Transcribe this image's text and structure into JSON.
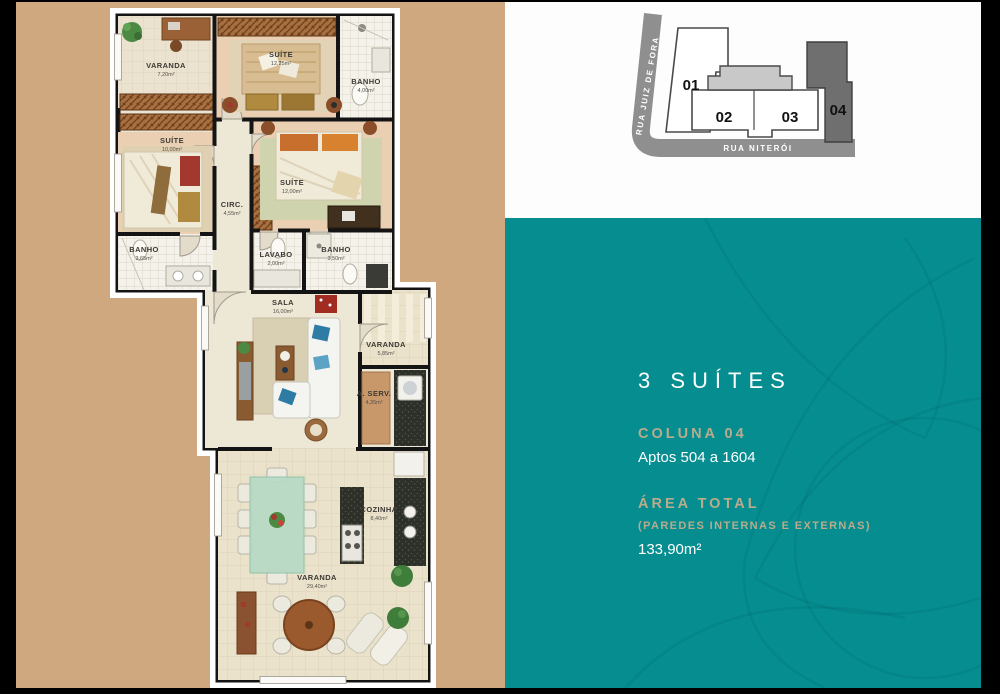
{
  "colors": {
    "tan_background": "#cfa87f",
    "teal_background": "#058d90",
    "accent_gold": "#b9ab8c",
    "street_gray": "#8f8f8f",
    "unit_highlight_gray": "#6f6f6f",
    "wall_black": "#141414"
  },
  "site_diagram": {
    "street_left": "RUA JUIZ DE FORA",
    "street_bottom": "RUA NITERÓI",
    "units": [
      {
        "label": "01",
        "highlighted": false
      },
      {
        "label": "02",
        "highlighted": false
      },
      {
        "label": "03",
        "highlighted": false
      },
      {
        "label": "04",
        "highlighted": true
      }
    ]
  },
  "info_panel": {
    "title": "3 SUÍTES",
    "column_label": "COLUNA 04",
    "apartments_range": "Aptos 504 a 1604",
    "area_title": "ÁREA TOTAL",
    "area_subtitle": "(PAREDES INTERNAS E EXTERNAS)",
    "area_value": "133,90m²"
  },
  "floor_plan": {
    "rooms": [
      {
        "name": "VARANDA",
        "area": "7,20m²"
      },
      {
        "name": "SUÍTE",
        "area": "12,25m²"
      },
      {
        "name": "BANHO",
        "area": "4,00m²"
      },
      {
        "name": "SUÍTE",
        "area": "10,00m²"
      },
      {
        "name": "CIRC.",
        "area": "4,55m²"
      },
      {
        "name": "SUÍTE",
        "area": "12,00m²"
      },
      {
        "name": "BANHO",
        "area": "3,65m²"
      },
      {
        "name": "LAVABO",
        "area": "2,00m²"
      },
      {
        "name": "BANHO",
        "area": "3,50m²"
      },
      {
        "name": "SALA",
        "area": "16,00m²"
      },
      {
        "name": "VARANDA",
        "area": "5,85m²"
      },
      {
        "name": "A. SERV.",
        "area": "4,35m²"
      },
      {
        "name": "COZINHA",
        "area": "8,40m²"
      },
      {
        "name": "VARANDA",
        "area": "29,40m²"
      }
    ]
  }
}
